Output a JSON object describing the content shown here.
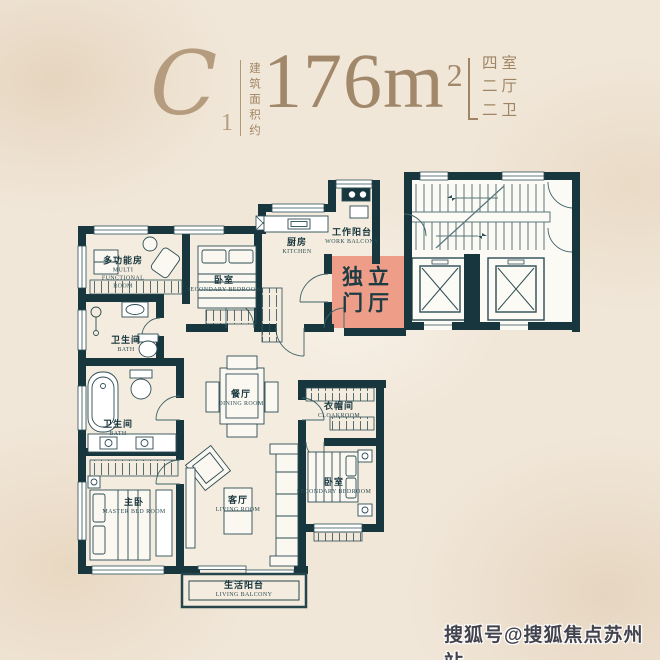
{
  "header": {
    "plan_code": "C",
    "plan_code_sub": "1",
    "area_label_vertical": "建筑面积约",
    "area_value": "176m",
    "area_sup": "2",
    "spec_lines": [
      "四室",
      "二厅",
      "二卫"
    ]
  },
  "floorplan": {
    "entrance_hall": {
      "line1": "独立",
      "line2": "门厅",
      "highlight_color": "#ee9d88"
    },
    "rooms": [
      {
        "id": "multi-functional-room",
        "zh": "多功能房",
        "en": "MULTI FUNCTIONAL ROOM"
      },
      {
        "id": "secondary-bedroom-top",
        "zh": "卧室",
        "en": "SECONDARY BEDROOM"
      },
      {
        "id": "kitchen",
        "zh": "厨房",
        "en": "KITCHEN"
      },
      {
        "id": "work-balcony",
        "zh": "工作阳台",
        "en": "WORK BALCONY"
      },
      {
        "id": "bath-upper",
        "zh": "卫生间",
        "en": "BATH"
      },
      {
        "id": "dining-room",
        "zh": "餐厅",
        "en": "DINING ROOM"
      },
      {
        "id": "cloakroom",
        "zh": "衣帽间",
        "en": "CLOAKROOM"
      },
      {
        "id": "bath-lower",
        "zh": "卫生间",
        "en": "BATH"
      },
      {
        "id": "master-bedroom",
        "zh": "主卧",
        "en": "MASTER BED ROOM"
      },
      {
        "id": "living-room",
        "zh": "客厅",
        "en": "LIVING ROOM"
      },
      {
        "id": "secondary-bedroom-bottom",
        "zh": "卧室",
        "en": "SECONDARY BEDROOM"
      },
      {
        "id": "living-balcony",
        "zh": "生活阳台",
        "en": "LIVING BALCONY"
      }
    ],
    "features": [
      "staircase",
      "two-elevators"
    ],
    "colors": {
      "wall": "#17363d",
      "highlight": "#ee9d88",
      "gold": "#a2886a",
      "background": "#f1e7d9"
    }
  },
  "watermark": {
    "text": "搜狐号@搜狐焦点苏州站"
  }
}
